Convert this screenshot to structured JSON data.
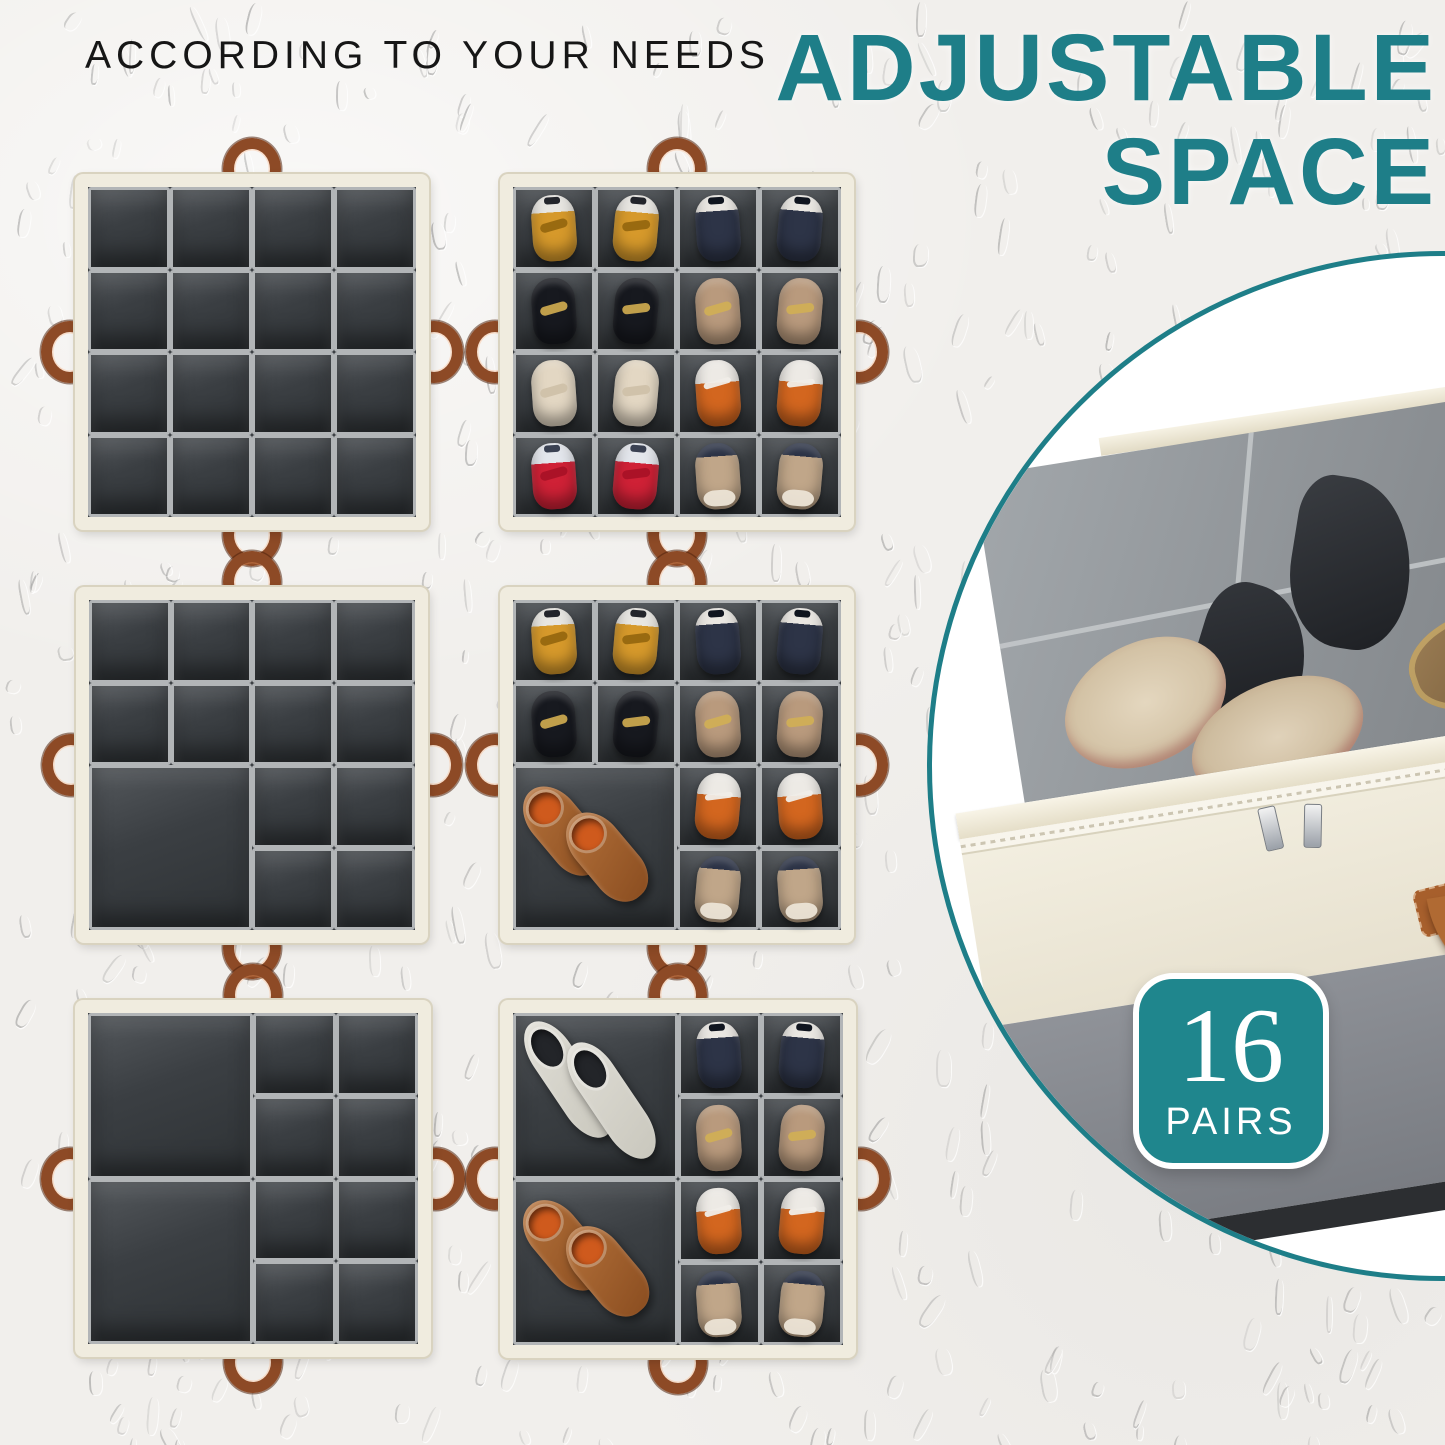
{
  "header": {
    "subtitle": "ACCORDING TO YOUR NEEDS",
    "title_line1": "ADJUSTABLE",
    "title_line2": "SPACE"
  },
  "badge": {
    "number": "16",
    "label": "PAIRS"
  },
  "colors": {
    "teal": "#1e7e88",
    "badge": "#1f868d",
    "bg": "#f1efec",
    "text": "#161616",
    "frame": "#f0ecdf",
    "frame_edge": "#d9d3c0",
    "interior": "#3a3e42",
    "cell_hi": "#b2b5b7",
    "handle": "#8d4a26"
  },
  "shoe_types": {
    "converse_yellow": {
      "band": "#e8e6e1",
      "band_h": "26%",
      "body": "#d6992b",
      "patch": "#23252b",
      "bar": "#96670f"
    },
    "sneaker_navy": {
      "band": "#eae7e2",
      "band_h": "24%",
      "body": "#2d3447",
      "patch": "#10151f",
      "bar": ""
    },
    "flat_black": {
      "band": "#17191f",
      "band_h": "0%",
      "body": "#17191f",
      "patch": "",
      "bar": "#c9a64e"
    },
    "flat_tan": {
      "band": "#b99a7d",
      "band_h": "0%",
      "body": "#b99a7d",
      "patch": "",
      "bar": "#d0ae56"
    },
    "flat_cream": {
      "band": "#e3d7c3",
      "band_h": "0%",
      "body": "#e3d7c3",
      "patch": "",
      "bar": "#cfc1a9"
    },
    "hightop_orange": {
      "band": "#edeae5",
      "band_h": "34%",
      "body": "#d3661f",
      "patch": "",
      "bar": "#f0ede8"
    },
    "converse_red": {
      "band": "#e3e6ec",
      "band_h": "30%",
      "body": "#cf2136",
      "patch": "#3a4152",
      "bar": "#a91227"
    },
    "sneaker_gold": {
      "band": "#2c3346",
      "band_h": "20%",
      "body": "#c0a689",
      "patch": "",
      "bar": "#ece4d6"
    },
    "loafer_tan": {
      "pbody": "#b4713a",
      "pbody2": "#8a4d20",
      "popen": "#cf5a1d"
    },
    "boot_white": {
      "pbody": "#e0ded6",
      "pbody2": "#c9c7bd",
      "popen": "#232529"
    }
  },
  "boxes": [
    {
      "name": "organizer-empty-16-cells",
      "x": 75,
      "y": 174,
      "w": 354,
      "h": 356,
      "grid": {
        "cols": 4,
        "rows": 4
      },
      "shoes": null
    },
    {
      "name": "organizer-empty-13-cells",
      "x": 76,
      "y": 587,
      "w": 352,
      "h": 356,
      "cells": [
        {
          "x": 0,
          "y": 0,
          "w": 0.25,
          "h": 0.25
        },
        {
          "x": 0.25,
          "y": 0,
          "w": 0.25,
          "h": 0.25
        },
        {
          "x": 0.5,
          "y": 0,
          "w": 0.25,
          "h": 0.25
        },
        {
          "x": 0.75,
          "y": 0,
          "w": 0.25,
          "h": 0.25
        },
        {
          "x": 0,
          "y": 0.25,
          "w": 0.25,
          "h": 0.25
        },
        {
          "x": 0.25,
          "y": 0.25,
          "w": 0.25,
          "h": 0.25
        },
        {
          "x": 0.5,
          "y": 0.25,
          "w": 0.25,
          "h": 0.25
        },
        {
          "x": 0.75,
          "y": 0.25,
          "w": 0.25,
          "h": 0.25
        },
        {
          "x": 0,
          "y": 0.5,
          "w": 0.5,
          "h": 0.5
        },
        {
          "x": 0.5,
          "y": 0.5,
          "w": 0.25,
          "h": 0.25
        },
        {
          "x": 0.75,
          "y": 0.5,
          "w": 0.25,
          "h": 0.25
        },
        {
          "x": 0.5,
          "y": 0.75,
          "w": 0.25,
          "h": 0.25
        },
        {
          "x": 0.75,
          "y": 0.75,
          "w": 0.25,
          "h": 0.25
        }
      ],
      "shoes": null
    },
    {
      "name": "organizer-empty-10-cells",
      "x": 75,
      "y": 1000,
      "w": 356,
      "h": 357,
      "cells": [
        {
          "x": 0,
          "y": 0,
          "w": 0.5,
          "h": 0.5
        },
        {
          "x": 0,
          "y": 0.5,
          "w": 0.5,
          "h": 0.5
        },
        {
          "x": 0.5,
          "y": 0,
          "w": 0.25,
          "h": 0.25
        },
        {
          "x": 0.75,
          "y": 0,
          "w": 0.25,
          "h": 0.25
        },
        {
          "x": 0.5,
          "y": 0.25,
          "w": 0.25,
          "h": 0.25
        },
        {
          "x": 0.75,
          "y": 0.25,
          "w": 0.25,
          "h": 0.25
        },
        {
          "x": 0.5,
          "y": 0.5,
          "w": 0.25,
          "h": 0.25
        },
        {
          "x": 0.75,
          "y": 0.5,
          "w": 0.25,
          "h": 0.25
        },
        {
          "x": 0.5,
          "y": 0.75,
          "w": 0.25,
          "h": 0.25
        },
        {
          "x": 0.75,
          "y": 0.75,
          "w": 0.25,
          "h": 0.25
        }
      ],
      "shoes": null
    },
    {
      "name": "organizer-filled-16-cells",
      "x": 500,
      "y": 174,
      "w": 354,
      "h": 356,
      "grid": {
        "cols": 4,
        "rows": 4
      },
      "shoes": [
        "converse_yellow",
        "converse_yellow",
        "sneaker_navy",
        "sneaker_navy",
        "flat_black",
        "flat_black",
        "flat_tan",
        "flat_tan",
        "flat_cream",
        "flat_cream",
        "hightop_orange",
        "hightop_orange",
        "converse_red",
        "converse_red",
        "sneaker_gold",
        "sneaker_gold"
      ]
    },
    {
      "name": "organizer-filled-13-cells",
      "x": 500,
      "y": 587,
      "w": 354,
      "h": 356,
      "cells": [
        {
          "x": 0,
          "y": 0,
          "w": 0.25,
          "h": 0.25
        },
        {
          "x": 0.25,
          "y": 0,
          "w": 0.25,
          "h": 0.25
        },
        {
          "x": 0.5,
          "y": 0,
          "w": 0.25,
          "h": 0.25
        },
        {
          "x": 0.75,
          "y": 0,
          "w": 0.25,
          "h": 0.25
        },
        {
          "x": 0,
          "y": 0.25,
          "w": 0.25,
          "h": 0.25
        },
        {
          "x": 0.25,
          "y": 0.25,
          "w": 0.25,
          "h": 0.25
        },
        {
          "x": 0.5,
          "y": 0.25,
          "w": 0.25,
          "h": 0.25
        },
        {
          "x": 0.75,
          "y": 0.25,
          "w": 0.25,
          "h": 0.25
        },
        {
          "x": 0,
          "y": 0.5,
          "w": 0.5,
          "h": 0.5
        },
        {
          "x": 0.5,
          "y": 0.5,
          "w": 0.25,
          "h": 0.25
        },
        {
          "x": 0.75,
          "y": 0.5,
          "w": 0.25,
          "h": 0.25
        },
        {
          "x": 0.5,
          "y": 0.75,
          "w": 0.25,
          "h": 0.25
        },
        {
          "x": 0.75,
          "y": 0.75,
          "w": 0.25,
          "h": 0.25
        }
      ],
      "shoes": [
        "converse_yellow",
        "converse_yellow",
        "sneaker_navy",
        "sneaker_navy",
        "flat_black",
        "flat_black",
        "flat_tan",
        "flat_tan",
        "pair:loafer_tan",
        "hightop_orange",
        "hightop_orange",
        "sneaker_gold",
        "sneaker_gold"
      ]
    },
    {
      "name": "organizer-filled-10-cells",
      "x": 500,
      "y": 1000,
      "w": 356,
      "h": 358,
      "cells": [
        {
          "x": 0,
          "y": 0,
          "w": 0.5,
          "h": 0.5
        },
        {
          "x": 0,
          "y": 0.5,
          "w": 0.5,
          "h": 0.5
        },
        {
          "x": 0.5,
          "y": 0,
          "w": 0.25,
          "h": 0.25
        },
        {
          "x": 0.75,
          "y": 0,
          "w": 0.25,
          "h": 0.25
        },
        {
          "x": 0.5,
          "y": 0.25,
          "w": 0.25,
          "h": 0.25
        },
        {
          "x": 0.75,
          "y": 0.25,
          "w": 0.25,
          "h": 0.25
        },
        {
          "x": 0.5,
          "y": 0.5,
          "w": 0.25,
          "h": 0.25
        },
        {
          "x": 0.75,
          "y": 0.5,
          "w": 0.25,
          "h": 0.25
        },
        {
          "x": 0.5,
          "y": 0.75,
          "w": 0.25,
          "h": 0.25
        },
        {
          "x": 0.75,
          "y": 0.75,
          "w": 0.25,
          "h": 0.25
        }
      ],
      "shoes": [
        "pair:boot_white",
        "pair:loafer_tan",
        "sneaker_navy",
        "sneaker_navy",
        "flat_tan",
        "flat_tan",
        "hightop_orange",
        "hightop_orange",
        "sneaker_gold",
        "sneaker_gold"
      ]
    }
  ]
}
